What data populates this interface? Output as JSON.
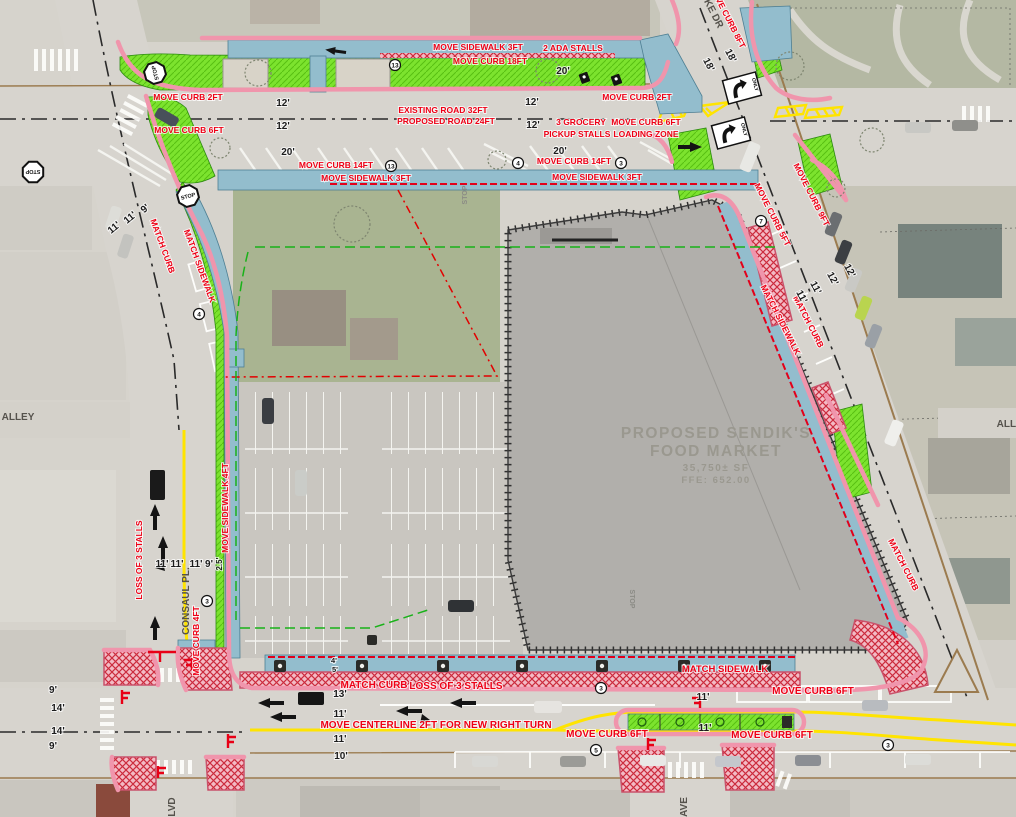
{
  "meta": {
    "type": "civil-site-improvement-plan",
    "description": "Curb and sidewalk relocation plan over aerial photo for proposed grocery store"
  },
  "building": {
    "lines": [
      "PROPOSED  SENDIK'S",
      "FOOD  MARKET",
      "35,750±  SF",
      "FFE: 652.00"
    ]
  },
  "colors": {
    "annotation_red": "#ee0016",
    "dimension_black": "#1c1c1c",
    "curb_pink": "#f095ac",
    "terrace_green": "#7ce32e",
    "sidewalk_blue": "#93bdcd",
    "hatch_red": "#cc2b3d",
    "centerline_yellow": "#ffe400",
    "building_gray": "#b1afab"
  },
  "red_labels": [
    {
      "t": "MOVE SIDEWALK 3FT",
      "x": 478,
      "y": 50
    },
    {
      "t": "2 ADA STALLS",
      "x": 573,
      "y": 51
    },
    {
      "t": "MOVE CURB 18FT",
      "x": 490,
      "y": 64
    },
    {
      "t": "MOVE CURB 2FT",
      "x": 188,
      "y": 100
    },
    {
      "t": "MOVE CURB 2FT",
      "x": 637,
      "y": 100
    },
    {
      "t": "EXISTING ROAD 32FT",
      "x": 443,
      "y": 113
    },
    {
      "t": "PROPOSED ROAD 24FT",
      "x": 446,
      "y": 124
    },
    {
      "t": "MOVE CURB 6FT",
      "x": 189,
      "y": 133
    },
    {
      "t": "3 GROCERY",
      "x": 581,
      "y": 125
    },
    {
      "t": "PICKUP STALLS",
      "x": 577,
      "y": 137
    },
    {
      "t": "MOVE CURB 6FT",
      "x": 646,
      "y": 125
    },
    {
      "t": "LOADING ZONE",
      "x": 646,
      "y": 137
    },
    {
      "t": "MOVE CURB 14FT",
      "x": 336,
      "y": 168
    },
    {
      "t": "MOVE CURB 14FT",
      "x": 574,
      "y": 164
    },
    {
      "t": "MOVE SIDEWALK 3FT",
      "x": 366,
      "y": 181
    },
    {
      "t": "MOVE SIDEWALK 3FT",
      "x": 597,
      "y": 180
    },
    {
      "t": "MOVE CURB 8FT",
      "x": 725,
      "y": 18,
      "r": 63
    },
    {
      "t": "MOVE CURB 5FT",
      "x": 770,
      "y": 216,
      "r": 63
    },
    {
      "t": "MOVE CURB 9FT",
      "x": 809,
      "y": 196,
      "r": 63
    },
    {
      "t": "MATCH SIDEWALK",
      "x": 778,
      "y": 321,
      "r": 63
    },
    {
      "t": "MATCH CURB",
      "x": 806,
      "y": 323,
      "r": 63
    },
    {
      "t": "MATCH CURB",
      "x": 901,
      "y": 566,
      "r": 63
    },
    {
      "t": "MATCH CURB",
      "x": 160,
      "y": 247,
      "r": 70
    },
    {
      "t": "MATCH SIDEWALK",
      "x": 197,
      "y": 267,
      "r": 70
    },
    {
      "t": "LOSS OF 3 STALLS",
      "x": 142,
      "y": 560,
      "r": -90
    },
    {
      "t": "MOVE SIDEWALK 4FT",
      "x": 228,
      "y": 508,
      "r": -90
    },
    {
      "t": "MOVE CURB 4FT",
      "x": 199,
      "y": 641,
      "r": -90
    },
    {
      "t": "MATCH CURB",
      "x": 374,
      "y": 688,
      "s": 10
    },
    {
      "t": "LOSS OF 3 STALLS",
      "x": 456,
      "y": 689,
      "s": 10
    },
    {
      "t": "MOVE CENTERLINE 2FT FOR NEW RIGHT TURN",
      "x": 436,
      "y": 728,
      "s": 10
    },
    {
      "t": "MOVE CURB 6FT",
      "x": 607,
      "y": 737,
      "s": 10
    },
    {
      "t": "MATCH SIDEWALK",
      "x": 725,
      "y": 672,
      "s": 9.5
    },
    {
      "t": "MOVE CURB 6FT",
      "x": 813,
      "y": 694,
      "s": 10
    },
    {
      "t": "MOVE CURB 6FT",
      "x": 772,
      "y": 738,
      "s": 10
    }
  ],
  "dimensions": [
    {
      "t": "12'",
      "x": 283,
      "y": 106
    },
    {
      "t": "12'",
      "x": 283,
      "y": 129
    },
    {
      "t": "12'",
      "x": 532,
      "y": 105
    },
    {
      "t": "12'",
      "x": 533,
      "y": 128
    },
    {
      "t": "20'",
      "x": 563,
      "y": 74
    },
    {
      "t": "20'",
      "x": 288,
      "y": 155
    },
    {
      "t": "20'",
      "x": 560,
      "y": 154
    },
    {
      "t": "18'",
      "x": 706,
      "y": 66,
      "r": 63
    },
    {
      "t": "18'",
      "x": 728,
      "y": 57,
      "r": 63
    },
    {
      "t": "11'",
      "x": 116,
      "y": 230,
      "r": -40
    },
    {
      "t": "11'",
      "x": 132,
      "y": 220,
      "r": -40
    },
    {
      "t": "9'",
      "x": 147,
      "y": 211,
      "r": -40
    },
    {
      "t": "11'",
      "x": 799,
      "y": 298,
      "r": 63
    },
    {
      "t": "11'",
      "x": 813,
      "y": 289,
      "r": 63
    },
    {
      "t": "12'",
      "x": 830,
      "y": 280,
      "r": 63
    },
    {
      "t": "12'",
      "x": 847,
      "y": 272,
      "r": 63
    },
    {
      "t": "11'",
      "x": 162,
      "y": 567
    },
    {
      "t": "11'",
      "x": 177,
      "y": 567
    },
    {
      "t": "11'",
      "x": 196,
      "y": 567
    },
    {
      "t": "9'",
      "x": 209,
      "y": 567
    },
    {
      "t": "2.5'",
      "x": 222,
      "y": 564,
      "r": -90,
      "s": 8
    },
    {
      "t": "13'",
      "x": 340,
      "y": 697
    },
    {
      "t": "11'",
      "x": 340,
      "y": 717
    },
    {
      "t": "11'",
      "x": 340,
      "y": 742
    },
    {
      "t": "10'",
      "x": 341,
      "y": 759
    },
    {
      "t": "9'",
      "x": 53,
      "y": 693
    },
    {
      "t": "14'",
      "x": 58,
      "y": 711
    },
    {
      "t": "14'",
      "x": 58,
      "y": 734
    },
    {
      "t": "9'",
      "x": 53,
      "y": 749
    },
    {
      "t": "11'",
      "x": 703,
      "y": 700
    },
    {
      "t": "11'",
      "x": 705,
      "y": 731
    },
    {
      "t": "4'",
      "x": 334,
      "y": 663,
      "s": 7.5
    },
    {
      "t": "5'",
      "x": 335,
      "y": 672,
      "s": 7.5
    }
  ],
  "street_labels": [
    {
      "t": "KE DR",
      "x": 711,
      "y": 15,
      "r": 63
    },
    {
      "t": "ALLEY",
      "x": 18,
      "y": 420
    },
    {
      "t": "ALLEY",
      "x": 1013,
      "y": 427
    },
    {
      "t": "CONSAUL PL.",
      "x": 189,
      "y": 601,
      "r": -90
    },
    {
      "t": "LVD",
      "x": 175,
      "y": 807,
      "r": -90
    },
    {
      "t": "AVE",
      "x": 687,
      "y": 807,
      "r": -90
    }
  ],
  "pavement_texts": [
    {
      "t": "STOP",
      "x": 467,
      "y": 195,
      "r": -90
    },
    {
      "t": "STOP",
      "x": 630,
      "y": 599,
      "r": 90
    }
  ],
  "keynotes": [
    {
      "n": "13",
      "x": 395,
      "y": 65
    },
    {
      "n": "13",
      "x": 391,
      "y": 166
    },
    {
      "n": "4",
      "x": 518,
      "y": 163
    },
    {
      "n": "3",
      "x": 621,
      "y": 163
    },
    {
      "n": "7",
      "x": 761,
      "y": 221
    },
    {
      "n": "4",
      "x": 199,
      "y": 314
    },
    {
      "n": "3",
      "x": 207,
      "y": 601
    },
    {
      "n": "3",
      "x": 601,
      "y": 688
    },
    {
      "n": "5",
      "x": 596,
      "y": 750
    },
    {
      "n": "3",
      "x": 888,
      "y": 745
    }
  ],
  "signs": {
    "stop_text": "STOP",
    "only_text": "ONLY",
    "stop_positions": [
      {
        "x": 155,
        "y": 73,
        "r": -105
      },
      {
        "x": 33,
        "y": 172,
        "r": 180
      },
      {
        "x": 188,
        "y": 196,
        "r": -15
      }
    ],
    "only_positions": [
      {
        "x": 742,
        "y": 88,
        "r": -15
      },
      {
        "x": 731,
        "y": 133,
        "r": -15
      }
    ]
  }
}
